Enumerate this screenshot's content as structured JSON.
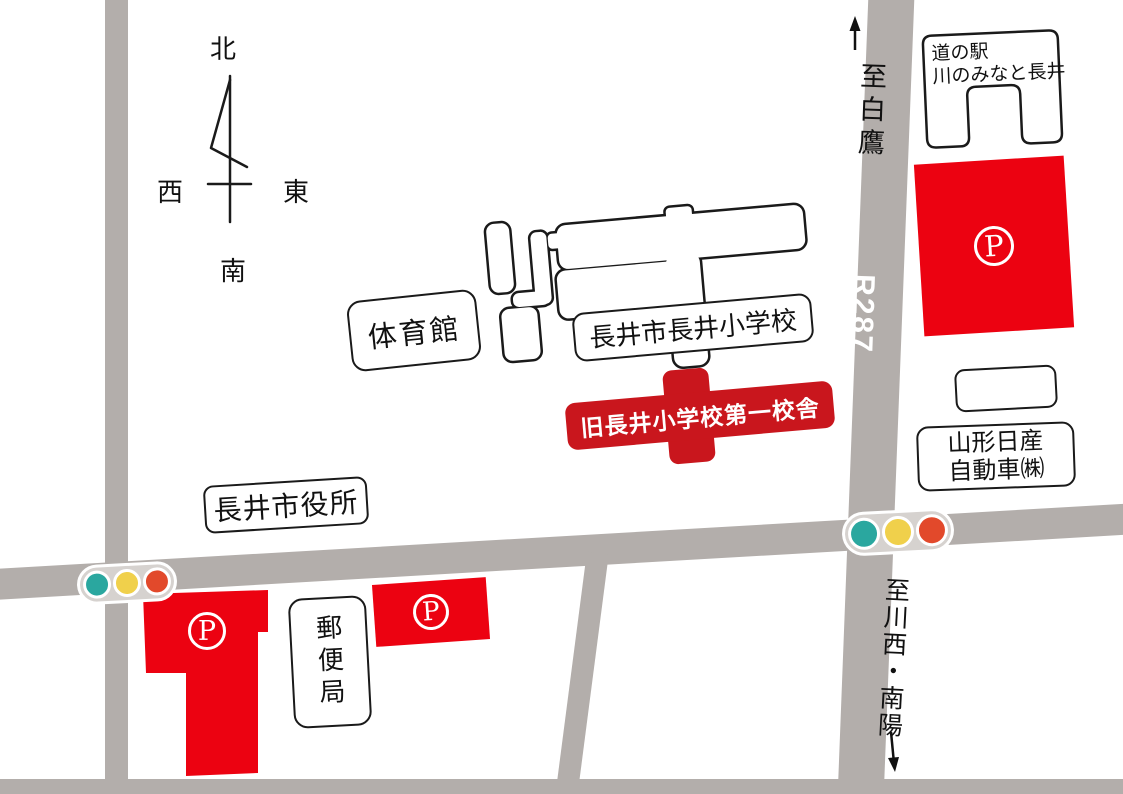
{
  "compass": {
    "north": "北",
    "south": "南",
    "east": "東",
    "west": "西"
  },
  "roads": {
    "route_label": "R287",
    "north_destination": "至白鷹",
    "south_destination": "至川西・南陽"
  },
  "places": {
    "roadside_station_line1": "道の駅",
    "roadside_station_line2": "川のみなと長井",
    "elementary_school": "長井市長井小学校",
    "gymnasium": "体育館",
    "old_school_building": "旧長井小学校第一校舎",
    "city_hall": "長井市役所",
    "post_office": "郵便局",
    "nissan_line1": "山形日産",
    "nissan_line2": "自動車㈱"
  },
  "parking": {
    "symbol": "P"
  },
  "colors": {
    "road": "#b3aeab",
    "parking_red": "#ec0211",
    "marker_red": "#c9161d",
    "signal_green": "#2aa79f",
    "signal_yellow": "#f0d04b",
    "signal_red": "#e2492b",
    "signal_body": "#d6d2cf",
    "outline": "#1a1a1a"
  }
}
